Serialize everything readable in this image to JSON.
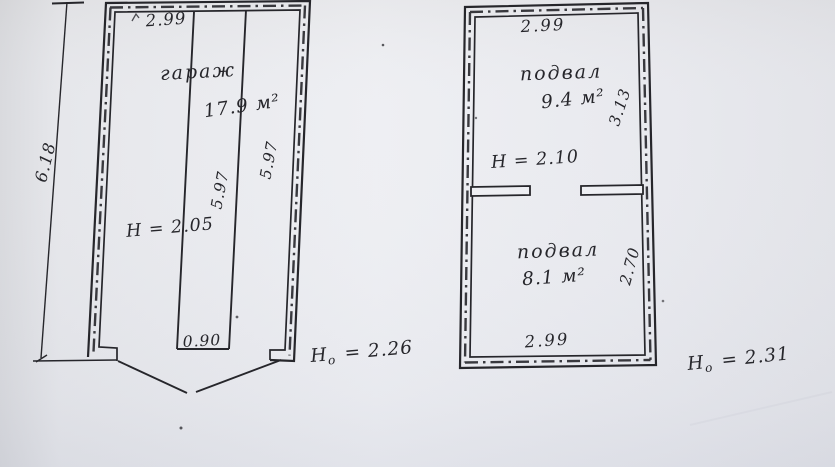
{
  "document": {
    "kind": "scanned technical floor plan, two rooms (garage and basement), hand-lettered dimensions in metres"
  },
  "left_plan": {
    "top_width": "2.99",
    "room": "гараж",
    "area": "17.9 м²",
    "inner_length_left": "5.97",
    "inner_length_right": "5.97",
    "ceiling_height": "H = 2.05",
    "pit_width": "0.90",
    "outer_length": "6.18",
    "outer_height": {
      "base": "H",
      "sub": "o",
      "value": " = 2.26"
    }
  },
  "right_plan": {
    "top_width": "2.99",
    "room1": {
      "name": "подвал",
      "area": "9.4 м²",
      "side_length": "3.13",
      "ceiling_height": "H = 2.10"
    },
    "room2": {
      "name": "подвал",
      "area": "8.1 м²",
      "side_length": "2.70"
    },
    "bottom_width": "2.99",
    "outer_height": {
      "base": "H",
      "sub": "o",
      "value": " = 2.31"
    }
  },
  "colors": {
    "ink": "#26262b",
    "paper": "#e8e9ee"
  }
}
